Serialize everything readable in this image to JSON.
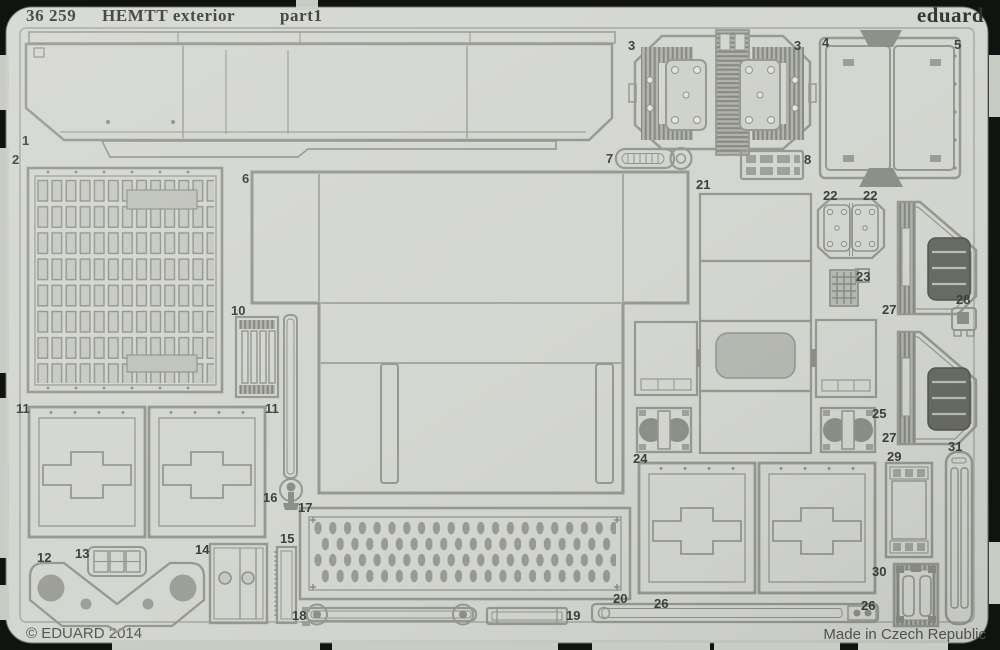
{
  "header": {
    "catalog": "36 259",
    "title": "HEMTT exterior",
    "part": "part1",
    "brand": "eduard"
  },
  "footer": {
    "copyright": "© EDUARD 2014",
    "made_in": "Made in Czech Republic"
  },
  "sheet": {
    "kind": "photo-etched metal detail fret",
    "colors": {
      "metal": "#d3d5d0",
      "outline": "#94978e",
      "dark_fill": "#8b8e86",
      "background": "#111310",
      "label_ink": "#3a3c37"
    }
  },
  "part_labels": [
    {
      "part": "1",
      "text": "1"
    },
    {
      "part": "2",
      "text": "2"
    },
    {
      "part": "3",
      "text": "3"
    },
    {
      "part": "3",
      "text": "3"
    },
    {
      "part": "4",
      "text": "4"
    },
    {
      "part": "5",
      "text": "5"
    },
    {
      "part": "6",
      "text": "6"
    },
    {
      "part": "7",
      "text": "7"
    },
    {
      "part": "8",
      "text": "8"
    },
    {
      "part": "10",
      "text": "10"
    },
    {
      "part": "11",
      "text": "11"
    },
    {
      "part": "11",
      "text": "11"
    },
    {
      "part": "12",
      "text": "12"
    },
    {
      "part": "13",
      "text": "13"
    },
    {
      "part": "14",
      "text": "14"
    },
    {
      "part": "15",
      "text": "15"
    },
    {
      "part": "16",
      "text": "16"
    },
    {
      "part": "17",
      "text": "17"
    },
    {
      "part": "18",
      "text": "18"
    },
    {
      "part": "19",
      "text": "19"
    },
    {
      "part": "20",
      "text": "20"
    },
    {
      "part": "21",
      "text": "21"
    },
    {
      "part": "22",
      "text": "22"
    },
    {
      "part": "22",
      "text": "22"
    },
    {
      "part": "23",
      "text": "23"
    },
    {
      "part": "24",
      "text": "24"
    },
    {
      "part": "25",
      "text": "25"
    },
    {
      "part": "26",
      "text": "26"
    },
    {
      "part": "26",
      "text": "26"
    },
    {
      "part": "27",
      "text": "27"
    },
    {
      "part": "27",
      "text": "27"
    },
    {
      "part": "28",
      "text": "28"
    },
    {
      "part": "29",
      "text": "29"
    },
    {
      "part": "30",
      "text": "30"
    },
    {
      "part": "31",
      "text": "31"
    }
  ]
}
